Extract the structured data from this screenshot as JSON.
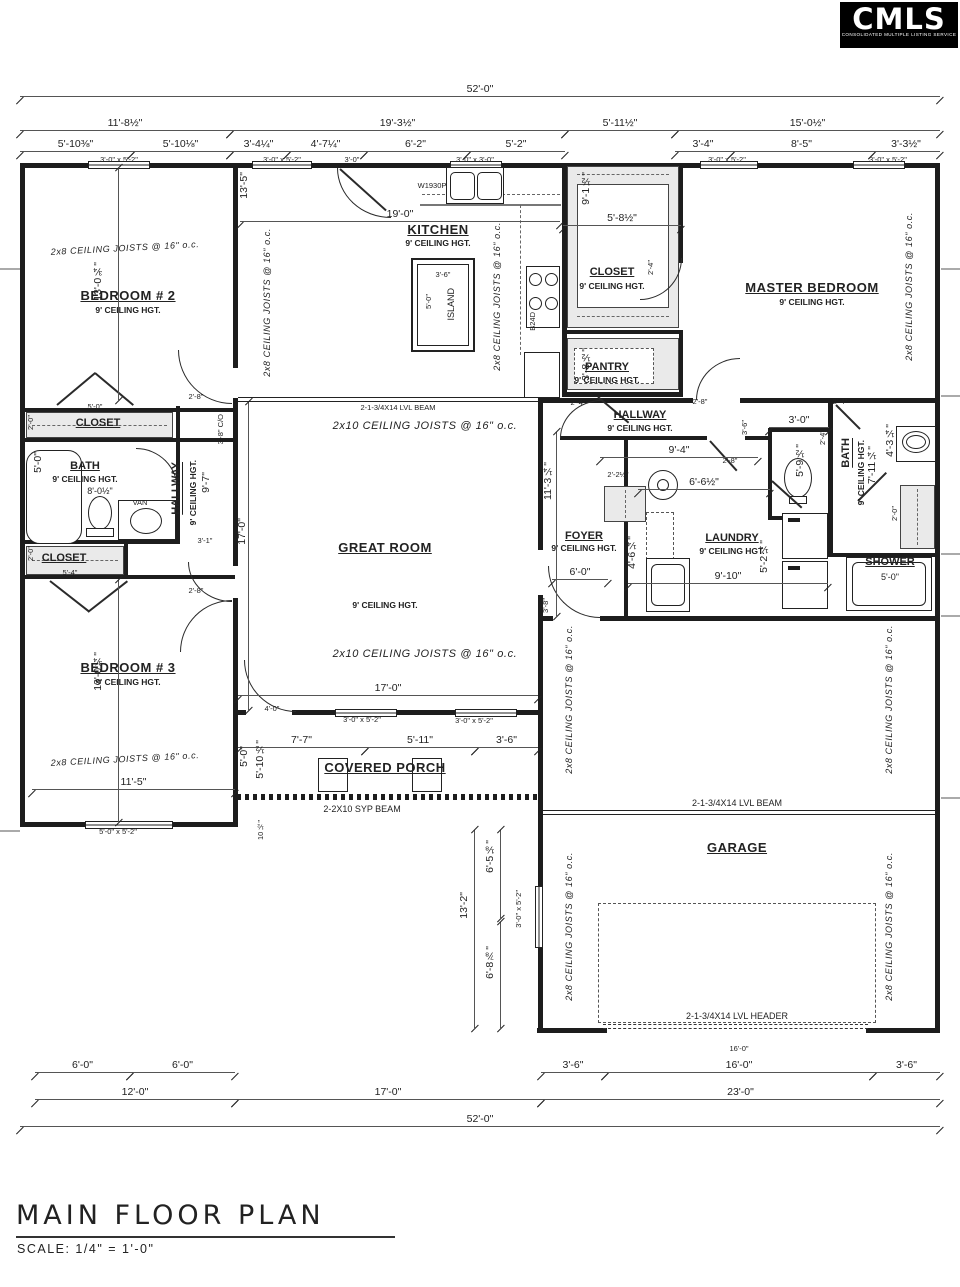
{
  "logo": {
    "brand": "CMLS",
    "tagline": "CONSOLIDATED MULTIPLE LISTING SERVICE"
  },
  "titleblock": {
    "title": "MAIN FLOOR PLAN",
    "scale": "SCALE: 1/4\" = 1'-0\""
  },
  "top": {
    "overall": "52'-0\"",
    "r2": [
      "11'-8½\"",
      "19'-3½\"",
      "5'-11½\"",
      "15'-0½\""
    ],
    "r3": [
      "5'-10⅜\"",
      "5'-10⅛\"",
      "3'-4¼\"",
      "4'-7¼\"",
      "6'-2\"",
      "5'-2\"",
      "3'-4\"",
      "8'-5\"",
      "3'-3½\""
    ],
    "w1": "3'-0\" x 5'-2\"",
    "w2": "3'-0\" x 5'-2\"",
    "door": "3'-0\"",
    "w3": "3'-0\" x 3'-0\"",
    "w4": "3'-0\" x 5'-2\"",
    "w5": "3'-0\" x 5'-2\""
  },
  "bottom": {
    "l1a": "6'-0\"",
    "l1b": "6'-0\"",
    "r1a": "3'-6\"",
    "r1b": "16'-0\"",
    "r1c": "3'-6\"",
    "r1small": "16'-0\"",
    "l2": "12'-0\"",
    "m2": "17'-0\"",
    "r2": "23'-0\"",
    "overall": "52'-0\""
  },
  "rooms": {
    "bedroom2": {
      "name": "BEDROOM # 2",
      "hgt": "9' CEILING HGT."
    },
    "bedroom3": {
      "name": "BEDROOM # 3",
      "hgt": "9' CEILING HGT."
    },
    "master": {
      "name": "MASTER BEDROOM",
      "hgt": "9' CEILING HGT."
    },
    "kitchen": {
      "name": "KITCHEN",
      "hgt": "9' CEILING HGT."
    },
    "island": {
      "name": "ISLAND",
      "w": "3'-6\"",
      "d": "5'-0\""
    },
    "great": {
      "name": "GREAT ROOM",
      "hgt": "9' CEILING HGT."
    },
    "closet_master": {
      "name": "CLOSET",
      "hgt": "9' CEILING HGT."
    },
    "pantry": {
      "name": "PANTRY",
      "hgt": "9' CEILING HGT."
    },
    "hallway2": {
      "name": "HALLWAY",
      "hgt": "9' CEILING HGT."
    },
    "hallway1": {
      "name": "HALLWAY",
      "hgt": "9' CEILING HGT."
    },
    "closet1": {
      "name": "CLOSET"
    },
    "closet2": {
      "name": "CLOSET"
    },
    "bath1": {
      "name": "BATH",
      "hgt": "9' CEILING HGT."
    },
    "bath2": {
      "name": "BATH",
      "hgt": "9' CEILING HGT."
    },
    "foyer": {
      "name": "FOYER",
      "hgt": "9' CEILING HGT."
    },
    "laundry": {
      "name": "LAUNDRY",
      "hgt": "9' CEILING HGT."
    },
    "shower": {
      "name": "SHOWER",
      "width": "5'-0\""
    },
    "porch": {
      "name": "COVERED PORCH"
    },
    "garage": {
      "name": "GARAGE"
    }
  },
  "structure": {
    "joists8": "2x8 CEILING JOISTS @ 16\" o.c.",
    "joists10": "2x10 CEILING JOISTS @ 16\" o.c.",
    "lvl_beam": "2-1-3/4X14 LVL BEAM",
    "lvl_header": "2-1-3/4X14 LVL HEADER",
    "syp_beam": "2-2X10 SYP BEAM"
  },
  "dims": {
    "bed2_h": "13'-0¾\"",
    "bed3_h": "13'-0¾\"",
    "k13_5": "13'-5\"",
    "k19": "19'-0\"",
    "clm_w": "5'-8½\"",
    "clm_h": "9'-1½\"",
    "pantry_h": "3'-8½\"",
    "hall2_w": "9'-4\"",
    "hall2_d": "3'-6\"",
    "wc_w": "3'-0\"",
    "wc_h": "5'-9½\"",
    "foyer_cl": "2'-2½\"",
    "laun_top": "6'-6½\"",
    "foyer_v": "11'-3¼\"",
    "foyer_h": "4'-6¼\"",
    "foyer_b": "6'-0\"",
    "foyer_s": "3'-8\"",
    "laun_w": "9'-10\"",
    "laun_v": "5'-2¼\"",
    "bath2_v": "7'-11¼\"",
    "bath2_van": "4'-3¼\"",
    "bath2_cl": "2'-0\"",
    "great_h": "17'-0\"",
    "great_w": "17'-0\"",
    "hall1_h": "9'-7\"",
    "hall1_w": "3'-1\"",
    "co": "3'-8\" C/O",
    "cl1_w": "5'-0\"",
    "cl1_d": "2'-0\"",
    "cl2_w": "5'-4\"",
    "cl2_d": "2'-0\"",
    "tub": "5'-0\"",
    "bath1_w": "8'-0½\"",
    "bed3_w": "11'-5\"",
    "bed3_win": "5'-0\" x 5'-2\"",
    "porch_a": "7'-7\"",
    "porch_b": "5'-11\"",
    "porch_c": "3'-6\"",
    "porch_v1": "5'-0\"",
    "porch_v2": "5'-10½\"",
    "porch_sm": "10½\"",
    "porch_door": "4'-0\"",
    "porch_w1": "3'-0\" x 5'-2\"",
    "porch_w2": "3'-0\" x 5'-2\"",
    "side_v": "13'-2\"",
    "gar_a": "6'-5⅛\"",
    "gar_b": "6'-8⅞\"",
    "gar_win": "3'-0\" x 5'-2\"",
    "d28": "2'-8\"",
    "d24": "2'-4\"",
    "d30": "3'-0\""
  },
  "fixtures": {
    "sink_cab": "W1930P",
    "range_cab": "B24D",
    "vanity": "VAN"
  }
}
